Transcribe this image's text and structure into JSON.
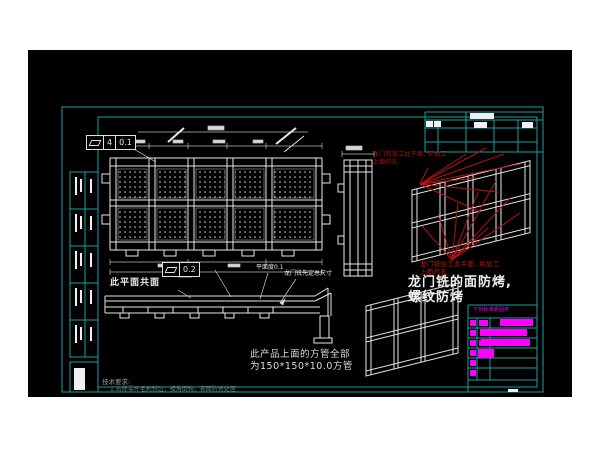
{
  "annotations": {
    "coplanar_label": "此平面共面",
    "flatness_label": "平面度0.1",
    "gantry_total_dim": "龙门铣先定总尺寸",
    "square_tube_note_1": "此产品上面的方管全部",
    "square_tube_note_2": "为150*150*10.0方管",
    "red_note_top_1": "龙门铣加工此平面, 并加工",
    "red_note_top_2": "上面的孔",
    "red_note_mid_1": "龙门铣加工此平面, 并加工",
    "red_note_mid_2": "上面的孔",
    "milled_face_note_1": "龙门铣的面防烤,",
    "milled_face_note_2": "螺纹防烤",
    "tech_req_title": "技术要求:",
    "tech_req_item_1": "1.去除零件毛刺锐边，棱角倒钝，表面防锈处理"
  },
  "gdt": {
    "top": {
      "symbol_icon": "flatness-parallelogram",
      "value_1": "4",
      "value_2": "0.1"
    },
    "mid": {
      "symbol_icon": "flatness-parallelogram",
      "value": "0.2"
    }
  },
  "fastener_table": {
    "header": "下列标准紧固件"
  },
  "colors": {
    "frame_teal": "#12A3A3",
    "white_line": "#E8E8E8",
    "annotation_red": "#B51212",
    "magenta": "#FF00FF",
    "dim_gray": "#8A8A8A"
  }
}
